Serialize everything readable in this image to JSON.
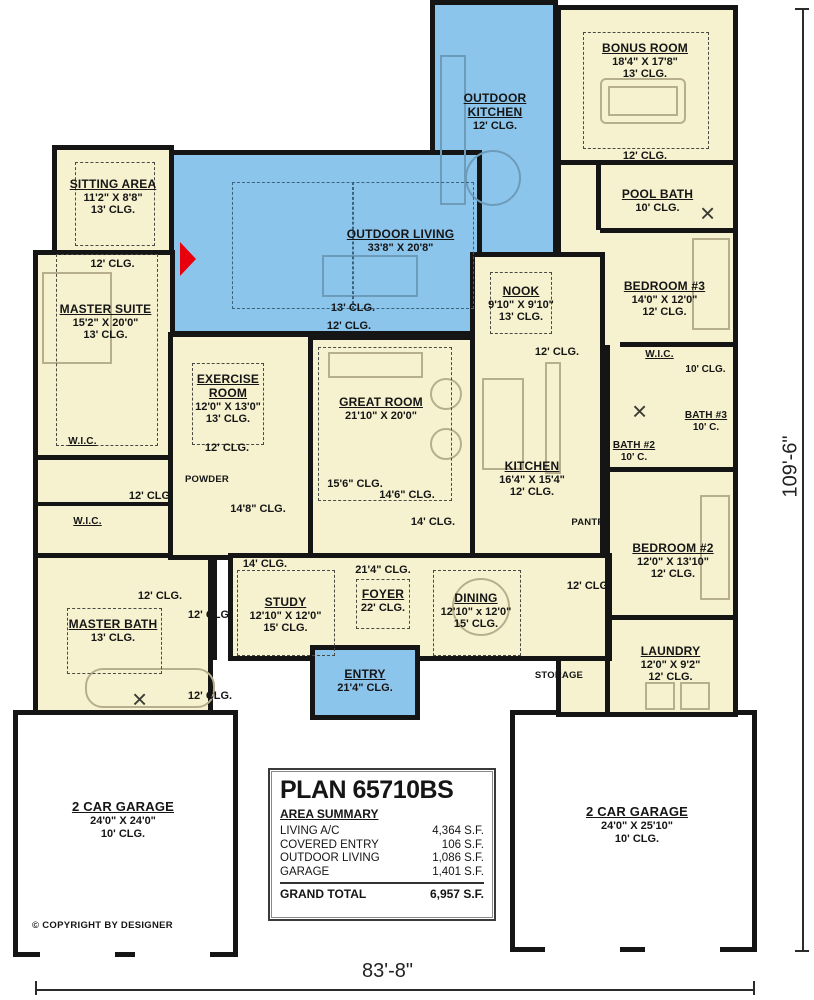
{
  "plan": {
    "title": "PLAN 65710BS",
    "area_summary_title": "AREA SUMMARY",
    "area_rows": [
      {
        "label": "LIVING A/C",
        "value": "4,364 S.F."
      },
      {
        "label": "COVERED ENTRY",
        "value": "106 S.F."
      },
      {
        "label": "OUTDOOR LIVING",
        "value": "1,086 S.F."
      },
      {
        "label": "GARAGE",
        "value": "1,401 S.F."
      }
    ],
    "grand_total": {
      "label": "GRAND TOTAL",
      "value": "6,957 S.F."
    },
    "copyright": "© COPYRIGHT BY DESIGNER",
    "overall_width": "83'-8\"",
    "overall_height": "109'-6\""
  },
  "rooms": {
    "sitting": {
      "name": "SITTING AREA",
      "size": "11'2\" X 8'8\"",
      "clg": "13' CLG."
    },
    "master_suite": {
      "name": "MASTER SUITE",
      "size": "15'2\" X 20'0\"",
      "clg": "13' CLG."
    },
    "outdoor_kitchen": {
      "name": "OUTDOOR KITCHEN",
      "clg": "12' CLG."
    },
    "outdoor_living": {
      "name": "OUTDOOR LIVING",
      "size": "33'8\" X 20'8\""
    },
    "bonus": {
      "name": "BONUS ROOM",
      "size": "18'4\" X 17'8\"",
      "clg": "13' CLG."
    },
    "pool_bath": {
      "name": "POOL BATH",
      "clg": "10' CLG."
    },
    "nook": {
      "name": "NOOK",
      "size": "9'10\" X 9'10\"",
      "clg": "13' CLG."
    },
    "bedroom3": {
      "name": "BEDROOM #3",
      "size": "14'0\" X 12'0\"",
      "clg": "12' CLG."
    },
    "exercise": {
      "name": "EXERCISE ROOM",
      "size": "12'0\" X 13'0\"",
      "clg": "13' CLG."
    },
    "great": {
      "name": "GREAT ROOM",
      "size": "21'10\" X 20'0\""
    },
    "kitchen": {
      "name": "KITCHEN",
      "size": "16'4\" X 15'4\"",
      "clg": "12' CLG."
    },
    "bath2": {
      "name": "BATH #2",
      "clg": "10' C."
    },
    "bath3": {
      "name": "BATH #3",
      "clg": "10' C."
    },
    "wic_right": {
      "name": "W.I.C.",
      "clg": "10' CLG."
    },
    "wic_top": {
      "name": "W.I.C."
    },
    "wic_bottom": {
      "name": "W.I.C."
    },
    "powder": {
      "name": "POWDER"
    },
    "pantry": {
      "name": "PANTRY"
    },
    "storage": {
      "name": "STORAGE"
    },
    "bedroom2": {
      "name": "BEDROOM #2",
      "size": "12'0\" X 13'10\"",
      "clg": "12' CLG."
    },
    "study": {
      "name": "STUDY",
      "size": "12'10\" X 12'0\"",
      "clg": "15' CLG."
    },
    "foyer": {
      "name": "FOYER",
      "clg": "22' CLG."
    },
    "dining": {
      "name": "DINING",
      "size": "12'10\" x 12'0\"",
      "clg": "15' CLG."
    },
    "master_bath": {
      "name": "MASTER BATH",
      "clg": "13' CLG."
    },
    "laundry": {
      "name": "LAUNDRY",
      "size": "12'0\" X 9'2\"",
      "clg": "12' CLG."
    },
    "entry": {
      "name": "ENTRY",
      "clg": "21'4\" CLG."
    },
    "garage_left": {
      "name": "2 CAR GARAGE",
      "size": "24'0\" X 24'0\"",
      "clg": "10' CLG."
    },
    "garage_right": {
      "name": "2 CAR GARAGE",
      "size": "24'0\" X 25'10\"",
      "clg": "10' CLG."
    }
  },
  "ceilings": {
    "under_sitting": "12' CLG.",
    "ol_13": "13' CLG.",
    "ol_12": "12' CLG.",
    "under_bonus": "12' CLG.",
    "nook_hall": "12' CLG.",
    "under_exercise": "12' CLG.",
    "great_156": "15'6\" CLG.",
    "great_146": "14'6\" CLG.",
    "great_14": "14' CLG.",
    "hall_148": "14'8\" CLG.",
    "left_hall_12": "12' CLG.",
    "above_study_14": "14' CLG.",
    "above_foyer_214": "21'4\" CLG.",
    "mb_12_a": "12' CLG.",
    "mb_12_b": "12' CLG.",
    "mb_12_c": "12' CLG.",
    "laundry_hall_12": "12' CLG.",
    "wic_right_10": "10' CLG."
  },
  "colors": {
    "outdoor_area": "#8cc5ec",
    "interior_area": "#f6f2cf",
    "walls": "#151515",
    "fireplace_accent": "#e8000d"
  }
}
